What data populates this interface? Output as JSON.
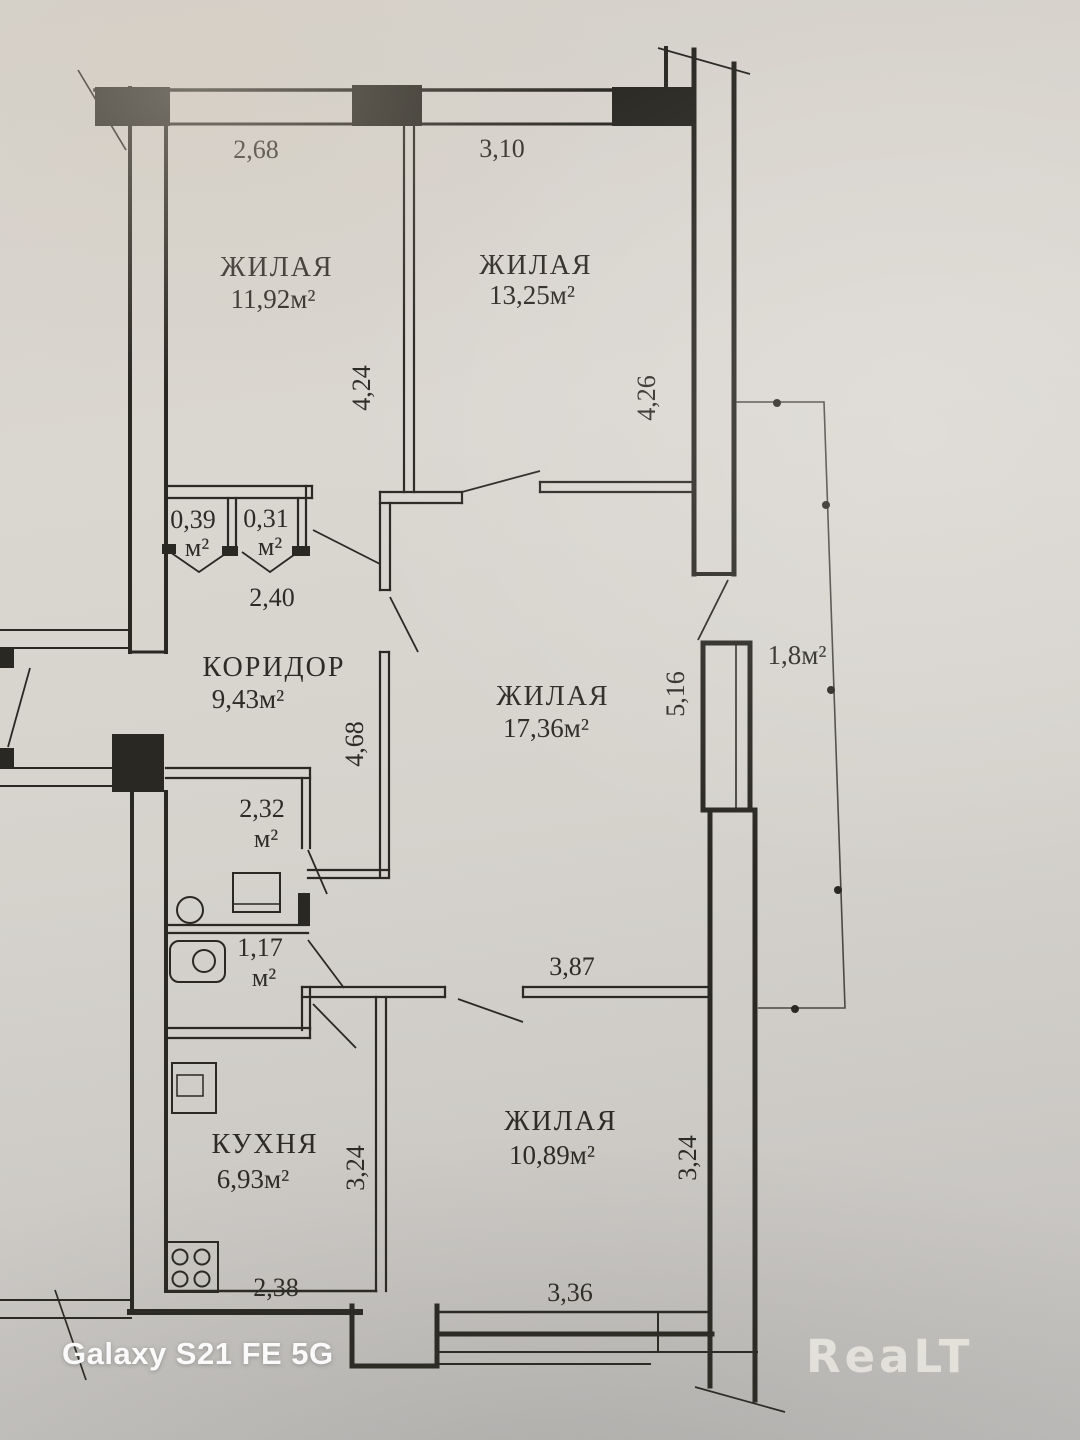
{
  "watermarks": {
    "device": "Galaxy S21 FE 5G",
    "brand": "ReaLT"
  },
  "colors": {
    "paper": "#d6d2cc",
    "ink": "#2a2822",
    "watermark_white": "#ffffff",
    "brand_gray": "#e7e4de"
  },
  "rooms": [
    {
      "id": "living-1",
      "name": "ЖИЛАЯ",
      "area": "11,92м²"
    },
    {
      "id": "living-2",
      "name": "ЖИЛАЯ",
      "area": "13,25м²"
    },
    {
      "id": "living-3",
      "name": "ЖИЛАЯ",
      "area": "17,36м²"
    },
    {
      "id": "living-4",
      "name": "ЖИЛАЯ",
      "area": "10,89м²"
    },
    {
      "id": "corridor",
      "name": "КОРИДОР",
      "area": "9,43м²"
    },
    {
      "id": "kitchen",
      "name": "КУХНЯ",
      "area": "6,93м²"
    },
    {
      "id": "closet-1",
      "area": "0,39",
      "unit": "м²"
    },
    {
      "id": "closet-2",
      "area": "0,31",
      "unit": "м²"
    },
    {
      "id": "bathroom",
      "area": "2,32",
      "unit": "м²"
    },
    {
      "id": "wc",
      "area": "1,17",
      "unit": "м²"
    },
    {
      "id": "balcony",
      "area": "1,8м²"
    }
  ],
  "dimensions": {
    "room1_width": "2,68",
    "room2_width": "3,10",
    "room1_height": "4,24",
    "room2_height": "4,26",
    "corridor_width": "2,40",
    "corridor_height": "4,68",
    "hall_height": "5,16",
    "hall_width": "3,87",
    "kitchen_height": "3,24",
    "kitchen_width": "2,38",
    "room4_width": "3,36",
    "room4_height": "3,24"
  }
}
